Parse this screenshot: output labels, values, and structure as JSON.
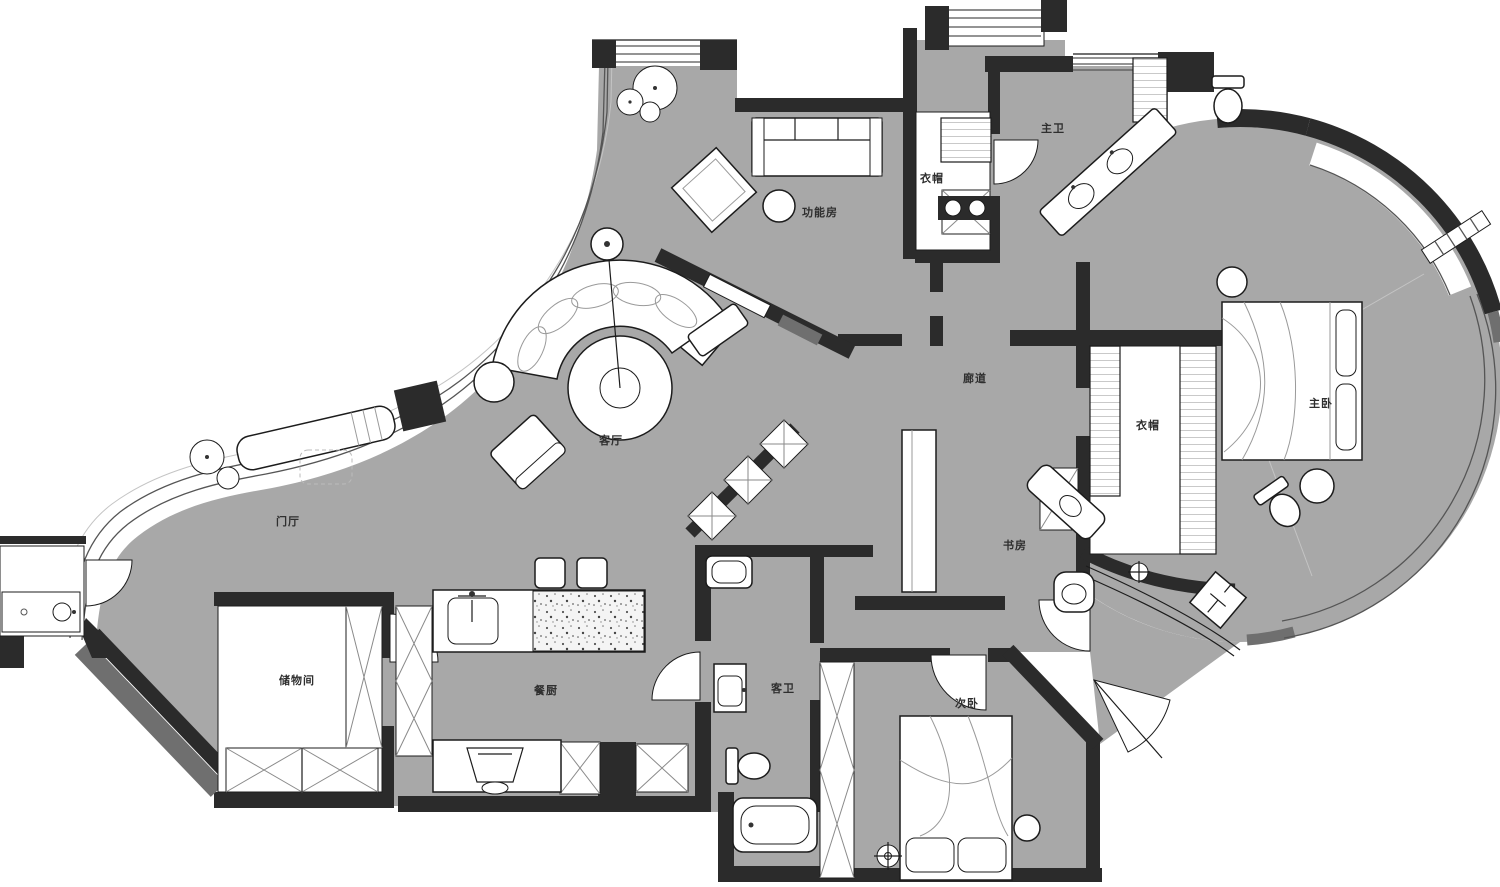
{
  "plan": {
    "type": "residential-floor-plan",
    "language": "zh-CN"
  },
  "colors": {
    "background": "#ffffff",
    "floor": "#a8a8a8",
    "wall": "#2b2b2b",
    "wall_gray": "#6f6f6f",
    "furniture": "#ffffff",
    "outline": "#1c1c1c",
    "glazing": "#555555",
    "label": "#2f2f2f"
  },
  "rooms": [
    {
      "id": "gongnengfang",
      "label": "功能房",
      "x": 820,
      "y": 212
    },
    {
      "id": "zhuwei",
      "label": "主卫",
      "x": 1053,
      "y": 128
    },
    {
      "id": "yimao-1",
      "label": "衣帽",
      "x": 932,
      "y": 178
    },
    {
      "id": "keting",
      "label": "客厅",
      "x": 611,
      "y": 440
    },
    {
      "id": "langdao",
      "label": "廊道",
      "x": 975,
      "y": 378
    },
    {
      "id": "yimao-2",
      "label": "衣帽",
      "x": 1148,
      "y": 425
    },
    {
      "id": "zhuwo",
      "label": "主卧",
      "x": 1321,
      "y": 403
    },
    {
      "id": "menting",
      "label": "门厅",
      "x": 288,
      "y": 521
    },
    {
      "id": "shufang",
      "label": "书房",
      "x": 1015,
      "y": 545
    },
    {
      "id": "chuwujian",
      "label": "储物间",
      "x": 297,
      "y": 680
    },
    {
      "id": "canchu",
      "label": "餐厨",
      "x": 546,
      "y": 690
    },
    {
      "id": "kewei",
      "label": "客卫",
      "x": 783,
      "y": 688
    },
    {
      "id": "ciwo",
      "label": "次卧",
      "x": 967,
      "y": 703
    }
  ]
}
